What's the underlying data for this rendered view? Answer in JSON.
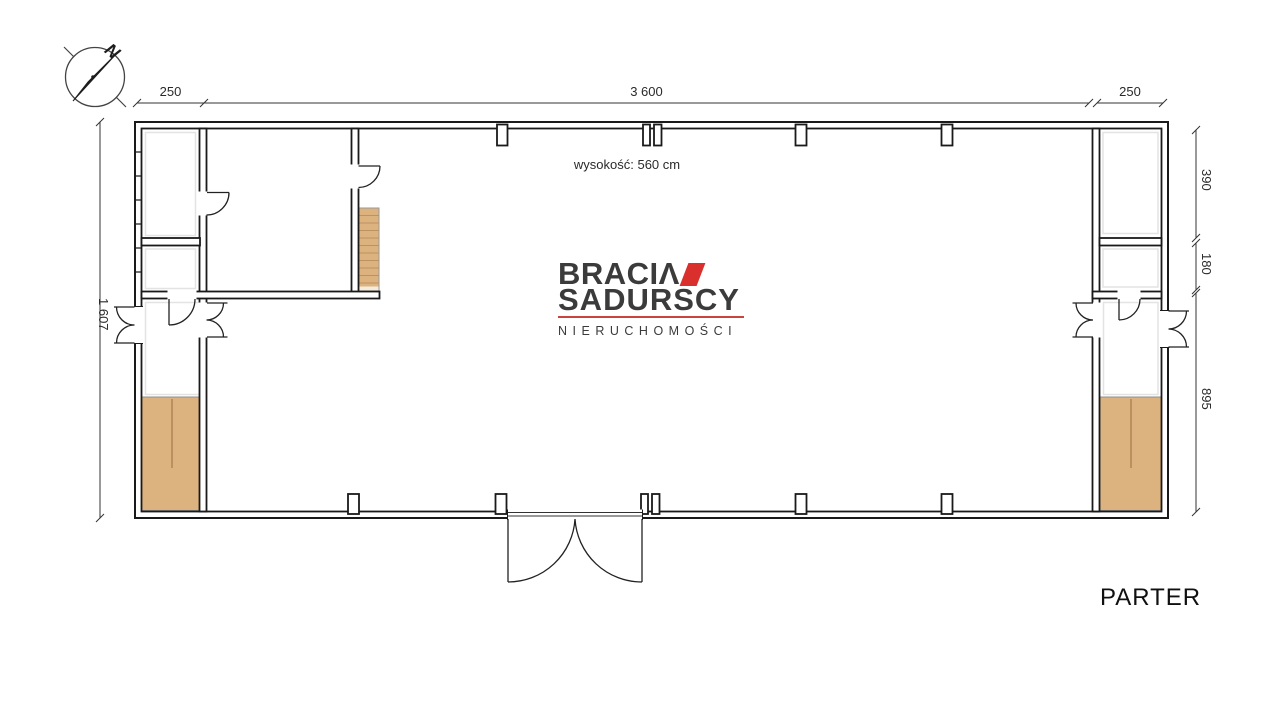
{
  "compass": {
    "north_label": "N"
  },
  "dims": {
    "top_left": "250",
    "top_span": "3 600",
    "top_right": "250",
    "left_height": "1 607",
    "right_top": "390",
    "right_middle": "180",
    "right_bottom": "895"
  },
  "notes": {
    "ceiling_height": "wysokość: 560 cm",
    "floor_name": "PARTER"
  },
  "logo": {
    "brand_line1": "BRACIΛ",
    "brand_line2": "SADURSCY",
    "brand_line3": "NIERUCHOMOŚCI"
  },
  "colors": {
    "accent_red": "#d9302e",
    "divider_red": "#c8453e",
    "wall_line": "#1a1a1a",
    "wood_floor": "#dcb37f",
    "wood_line": "#b9905f"
  }
}
